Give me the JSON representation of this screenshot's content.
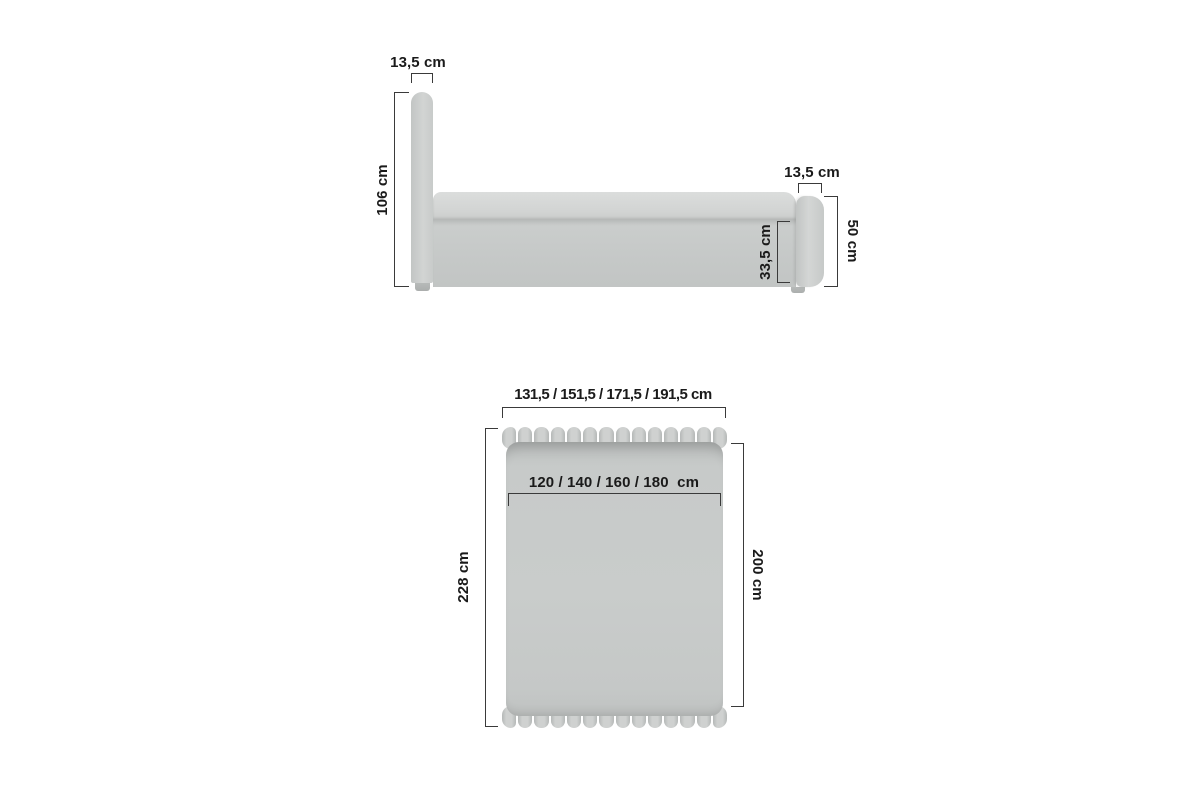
{
  "side_view": {
    "headboard_width_label": "13,5 cm",
    "headboard_height_label": "106 cm",
    "footboard_width_label": "13,5 cm",
    "footboard_height_label": "50 cm",
    "frame_height_label": "33,5 cm"
  },
  "top_view": {
    "total_width_label": "131,5 / 151,5 / 171,5 / 191,5 cm",
    "mattress_width_label": "120 / 140 / 160 / 180  cm",
    "total_length_label": "228 cm",
    "mattress_length_label": "200 cm"
  },
  "colors": {
    "upholstery_light": "#d6d8d7",
    "upholstery_mid": "#c8cbca",
    "upholstery_dark": "#bfc2c1",
    "dimension_line": "#3a3a3a",
    "label_text": "#1a1a1a"
  }
}
